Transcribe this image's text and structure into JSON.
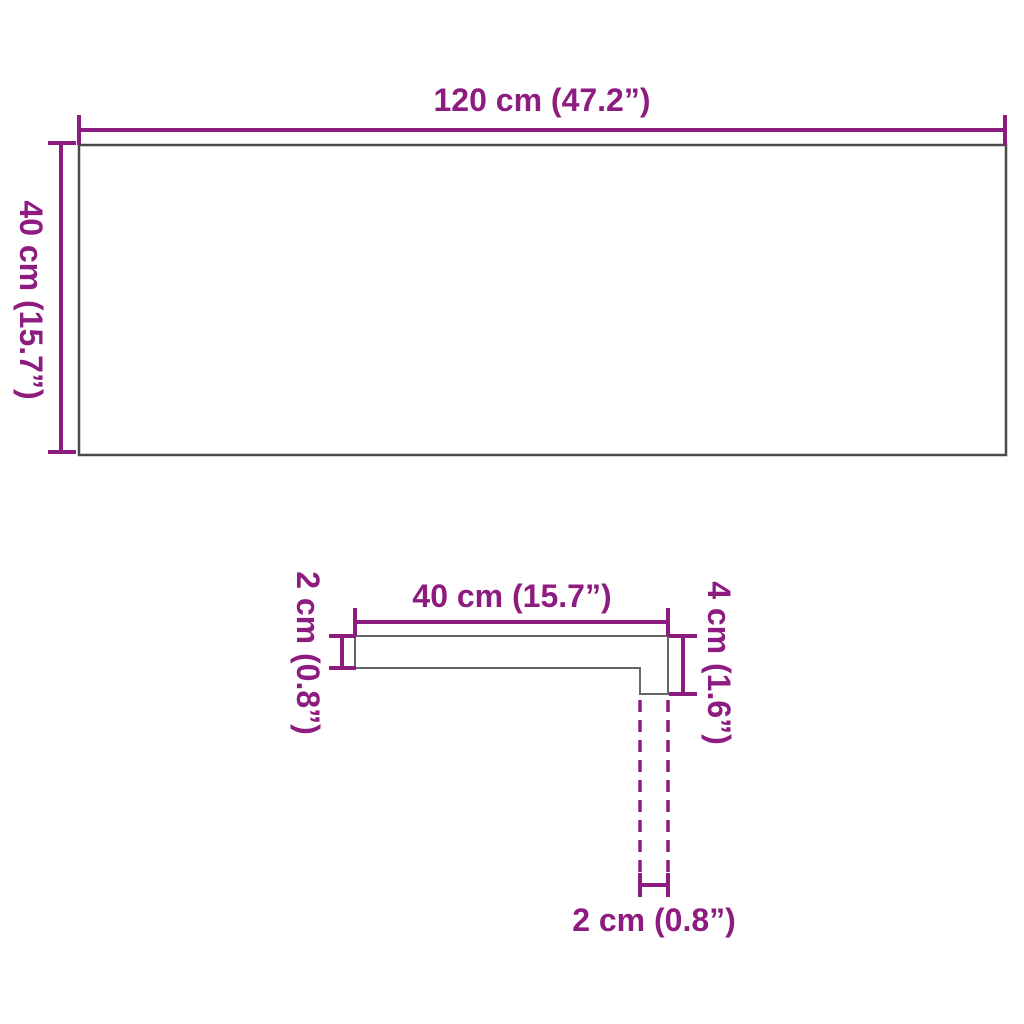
{
  "diagram": {
    "colors": {
      "dimension_accent": "#8E1C80",
      "panel_outline": "#4a4a4a",
      "profile_outline": "#666666",
      "background": "#ffffff"
    }
  },
  "top_view": {
    "width_label": "120 cm (47.2”)",
    "height_label": "40 cm (15.7”)"
  },
  "profile_view": {
    "width_label": "40 cm (15.7”)",
    "thickness_label": "2 cm (0.8”)",
    "height_label": "4 cm (1.6”)",
    "nose_label": "2 cm (0.8”)"
  }
}
